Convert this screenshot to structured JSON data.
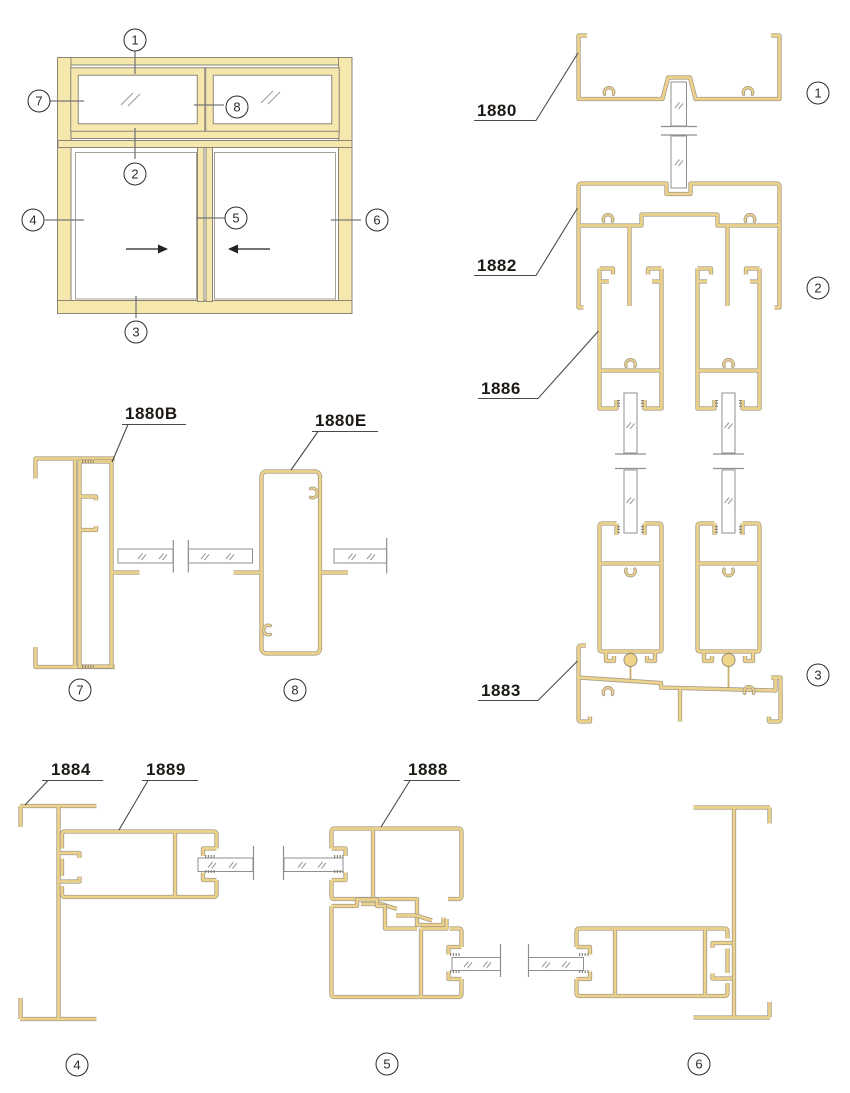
{
  "document": {
    "type": "aluminium sliding window profile section diagram",
    "colors": {
      "profile_gold": "#ECD28A",
      "profile_edge": "#A49B89",
      "elevation_fill": "#F6E7AD",
      "elevation_edge": "#8B8578",
      "glass_edge": "#8F8F8F",
      "callout_ink": "#2B2B2B",
      "label_ink": "#1D1A16"
    }
  },
  "labels": {
    "l1880": "1880",
    "l1882": "1882",
    "l1886": "1886",
    "l1883": "1883",
    "l1880B": "1880B",
    "l1880E": "1880E",
    "l1884": "1884",
    "l1889": "1889",
    "l1888": "1888"
  },
  "callouts": {
    "elevation": {
      "head": "1",
      "transom": "2",
      "sill": "3",
      "left_jamb": "4",
      "interlock": "5",
      "right_jamb": "6",
      "upper_left_jamb": "7",
      "upper_mullion": "8"
    },
    "vertical_sections": {
      "head": "1",
      "transom": "2",
      "sill": "3"
    },
    "upper_horizontal_sections": {
      "jamb": "7",
      "mullion": "8"
    },
    "lower_horizontal_sections": {
      "left_jamb": "4",
      "interlock": "5",
      "right_jamb": "6"
    }
  },
  "elevation": {
    "slide_direction_left_pane": "right",
    "slide_direction_right_pane": "left"
  }
}
